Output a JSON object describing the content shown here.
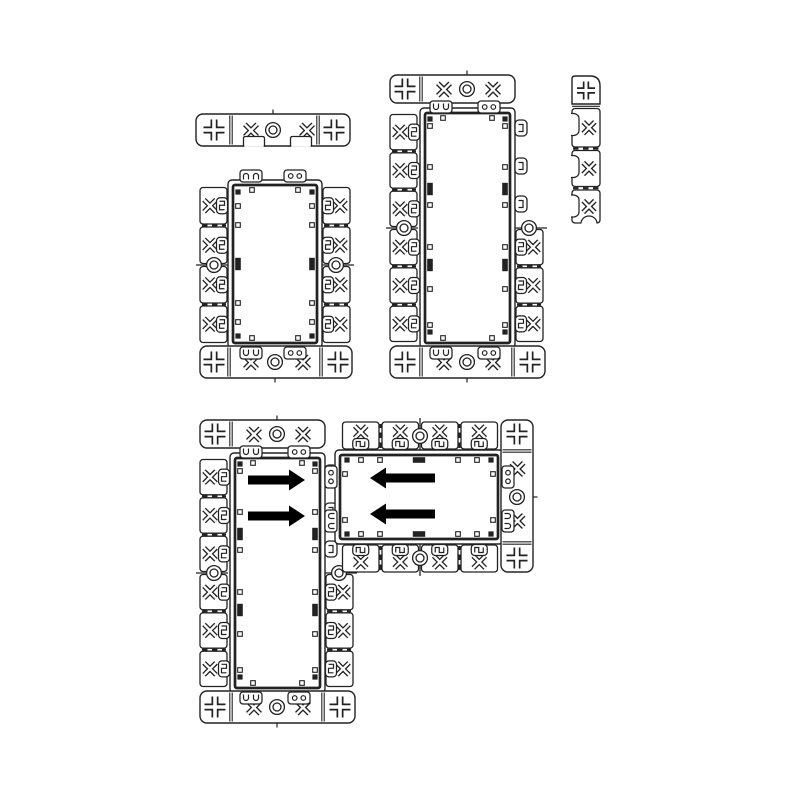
{
  "canvas": {
    "width": 800,
    "height": 800,
    "background": "#ffffff",
    "line_color": "#222222",
    "fill_color": "#ffffff",
    "arrow_color": "#000000"
  },
  "components": {
    "end_cap_bar": {
      "x": 196,
      "y": 114,
      "w": 154,
      "h": 32,
      "plus": [
        214,
        334
      ],
      "xmarks": [
        251,
        307
      ],
      "screw": 273,
      "dividers": [
        231,
        318
      ],
      "notches": [
        {
          "cx": 254,
          "w": 21
        },
        {
          "cx": 301,
          "w": 21
        }
      ]
    },
    "frame_two_module": {
      "body": {
        "x": 228,
        "y": 180,
        "w": 94,
        "h": 168
      },
      "top_tabs": [
        {
          "cx": 251,
          "variant": "claw"
        },
        {
          "cx": 295,
          "variant": "ring"
        }
      ],
      "left_wing": {
        "x": 200,
        "top": 186,
        "bottom": 344,
        "cells": 4
      },
      "right_wing": {
        "x": 322,
        "top": 186,
        "bottom": 344,
        "cells": 4
      },
      "bottom_bar": {
        "x": 200,
        "y": 346,
        "w": 152,
        "h": 32,
        "plus": [
          214,
          338
        ],
        "xmarks": [
          251,
          303
        ],
        "screw": 275,
        "dividers": [
          229,
          321
        ],
        "tabs": [
          {
            "cx": 251,
            "variant": "claw"
          },
          {
            "cx": 295,
            "variant": "ring"
          }
        ]
      },
      "inner_marks": {
        "corner_ys": [
          192,
          336
        ],
        "open_ys": [
          206,
          225,
          303,
          322
        ],
        "black_ys": [
          264
        ],
        "short_edge_open_xs": [
          252,
          298
        ]
      }
    },
    "frame_three_module": {
      "body": {
        "x": 420,
        "y": 108,
        "w": 95,
        "h": 240
      },
      "top_bar": {
        "x": 390,
        "y": 75,
        "w": 125,
        "h": 28,
        "plus": [
          405
        ],
        "xmarks": [
          444,
          493
        ],
        "screw": 467,
        "dividers": [
          421
        ],
        "tabs": [
          {
            "cx": 441,
            "variant": "claw"
          },
          {
            "cx": 489,
            "variant": "ring"
          }
        ]
      },
      "left_wing": {
        "x": 390,
        "top": 113,
        "bottom": 343,
        "cells": 6
      },
      "right_wing": {
        "x": 515,
        "top": 113,
        "bottom": 343,
        "cells": 6,
        "cells_from": 3,
        "hooks": [
          128,
          166,
          204
        ]
      },
      "bottom_bar": {
        "x": 390,
        "y": 346,
        "w": 155,
        "h": 32,
        "plus": [
          405,
          530
        ],
        "xmarks": [
          444,
          493
        ],
        "screw": 467,
        "dividers": [
          421,
          513
        ],
        "tabs": [
          {
            "cx": 441,
            "variant": "claw"
          },
          {
            "cx": 489,
            "variant": "ring"
          }
        ]
      },
      "inner_marks": {
        "corner_ys": [
          119,
          332
        ],
        "open_ys": [
          126,
          167,
          205,
          247,
          289,
          325
        ],
        "black_ys": [
          189,
          265
        ],
        "short_edge_open_xs": [
          443,
          492
        ]
      }
    },
    "breakaway_strip": {
      "x": 572,
      "y": 76,
      "w": 28,
      "plus_cell_h": 28,
      "plus_cx": 586,
      "plus_cy": 90.5,
      "cells": [
        {
          "y": 108.5,
          "h": 38.5
        },
        {
          "y": 150.5,
          "h": 36
        },
        {
          "y": 190,
          "h": 33
        }
      ],
      "xmark_x": 589,
      "dash_ys": [
        148.6,
        188.2
      ],
      "bottom_arc_cx": 589
    },
    "assembly": {
      "vertical_frame": {
        "base": "frame_three_module",
        "transform": "translate(-190,345)"
      },
      "horizontal_frame": {
        "base": "frame_two_module",
        "transform": "translate(155,772) rotate(-90)"
      },
      "arrows": [
        {
          "dir": "right",
          "tail_x": 248,
          "tip_x": 305,
          "y": 480
        },
        {
          "dir": "right",
          "tail_x": 248,
          "tip_x": 305,
          "y": 516
        },
        {
          "dir": "left",
          "tail_x": 435,
          "tip_x": 370,
          "y": 478
        },
        {
          "dir": "left",
          "tail_x": 435,
          "tip_x": 370,
          "y": 514
        }
      ]
    }
  }
}
